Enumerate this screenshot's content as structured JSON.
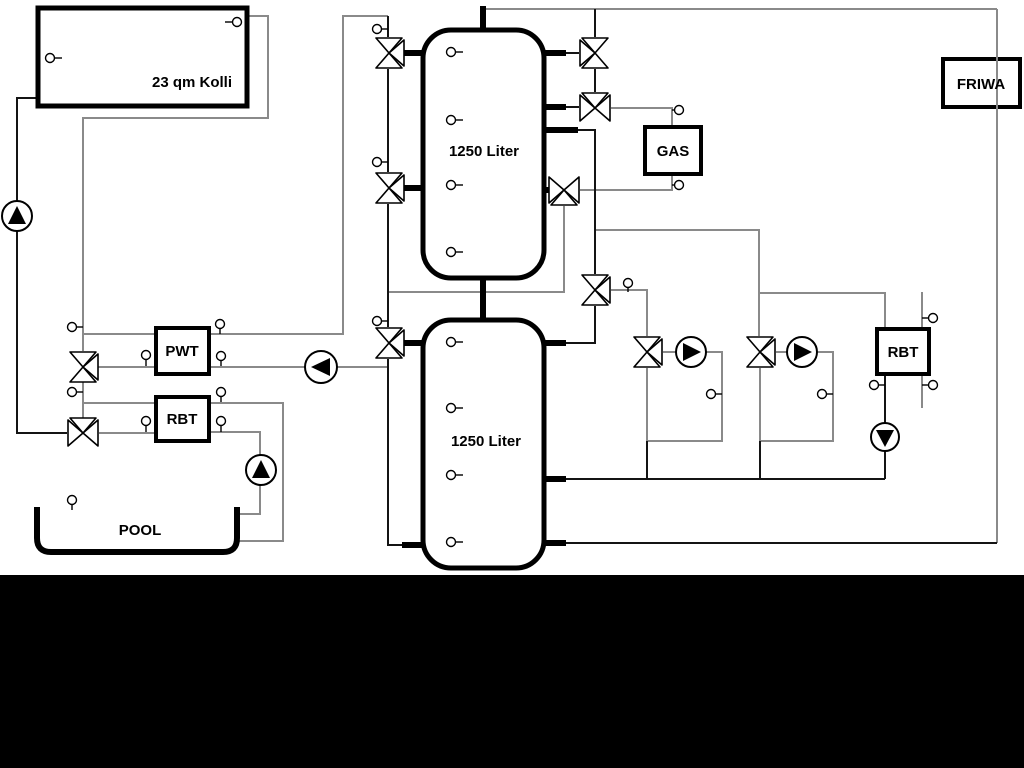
{
  "page": {
    "background": "#ffffff",
    "letterbox_color": "#000000",
    "diagram_type": "heating-system-schematic"
  },
  "labels": {
    "collector": "23 qm Kolli",
    "tank_top": "1250 Liter",
    "tank_bottom": "1250 Liter",
    "pwt": "PWT",
    "rbt_pool": "RBT",
    "gas": "GAS",
    "friwa": "FRIWA",
    "rbt_right": "RBT",
    "pool": "POOL"
  },
  "colors": {
    "pipe_gray": "#8a8a8a",
    "pipe_black": "#141414",
    "component_stroke": "#000000",
    "component_fill": "#ffffff"
  },
  "components": {
    "pumps": [
      {
        "name": "solar-pump",
        "direction": "up"
      },
      {
        "name": "pool-pump",
        "direction": "up"
      },
      {
        "name": "pwt-charge-pump",
        "direction": "left"
      },
      {
        "name": "heating-circuit-1-pump",
        "direction": "right"
      },
      {
        "name": "heating-circuit-2-pump",
        "direction": "right"
      },
      {
        "name": "rbt-right-pump",
        "direction": "down"
      }
    ],
    "three_way_valve_count": 11,
    "sensor_count": 30
  }
}
